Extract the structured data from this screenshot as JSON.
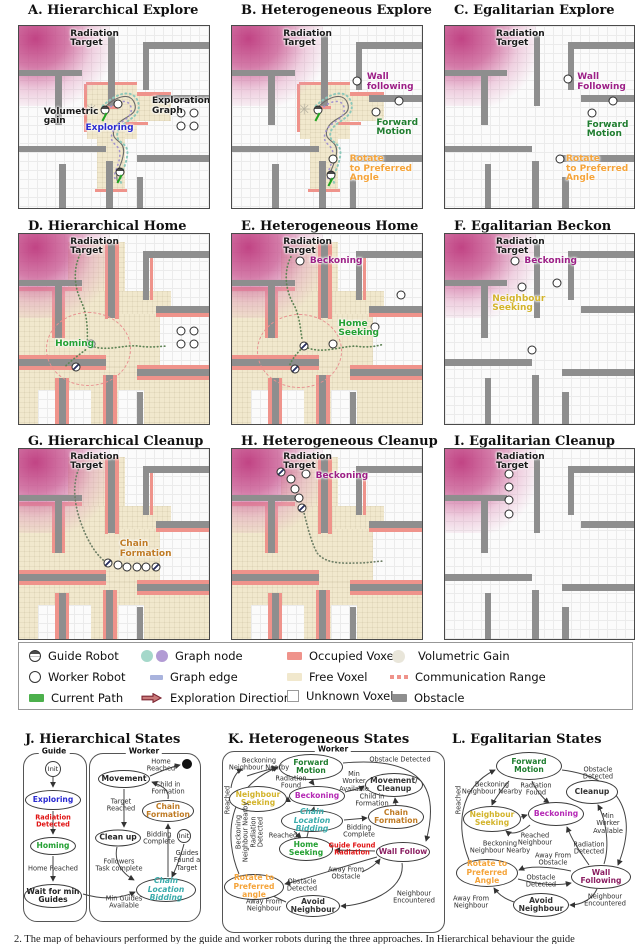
{
  "colors": {
    "radiation_pink": "#c04a82",
    "free_voxel": "#f1e8cd",
    "occupied_voxel": "#ef938b",
    "obstacle_gray": "#8e8e8e",
    "exploring_blue": "#2a2ad0",
    "homing_green": "#23a032",
    "forward_green": "#1f7d2f",
    "beckoning_magenta": "#9c1f86",
    "wall_follow_purple": "#8b1f62",
    "neighbour_yellow": "#d3b42b",
    "rotate_orange": "#f5a43a",
    "chain_brown": "#bf7b24",
    "bidding_teal": "#3aabab",
    "alert_red": "#e01212",
    "graph_node_teal": "#a5d8ca",
    "graph_node_purple": "#b29bd4",
    "graph_edge_lavender": "#a9b3dd",
    "current_path_green": "#4cb04c",
    "exploration_dir_red": "#8e2f3c"
  },
  "panels": [
    {
      "title": "A. Hierarchical Explore",
      "labels": [
        {
          "text": "Radiation\nTarget"
        },
        {
          "text": "Volumetric\ngain"
        },
        {
          "text": "Exploring"
        },
        {
          "text": "Exploration\nGraph"
        }
      ]
    },
    {
      "title": "B. Heterogeneous Explore",
      "labels": [
        {
          "text": "Radiation\nTarget"
        },
        {
          "text": "Wall\nfollowing"
        },
        {
          "text": "Forward\nMotion"
        },
        {
          "text": "Rotate\nto Preferred\nAngle"
        }
      ]
    },
    {
      "title": "C. Egalitarian Explore",
      "labels": [
        {
          "text": "Radiation\nTarget"
        },
        {
          "text": "Wall\nFollowing"
        },
        {
          "text": "Forward\nMotion"
        },
        {
          "text": "Rotate\nto Preferred\nAngle"
        }
      ]
    },
    {
      "title": "D. Hierarchical Home",
      "labels": [
        {
          "text": "Radiation\nTarget"
        },
        {
          "text": "Homing"
        }
      ]
    },
    {
      "title": "E. Heterogeneous Home",
      "labels": [
        {
          "text": "Radiation\nTarget"
        },
        {
          "text": "Beckoning"
        },
        {
          "text": "Home\nSeeking"
        }
      ]
    },
    {
      "title": "F. Egalitarian Beckon",
      "labels": [
        {
          "text": "Radiation\nTarget"
        },
        {
          "text": "Beckoning"
        },
        {
          "text": "Neighbour\nSeeking"
        }
      ]
    },
    {
      "title": "G. Hierarchical Cleanup",
      "labels": [
        {
          "text": "Radiation\nTarget"
        },
        {
          "text": "Chain\nFormation"
        }
      ]
    },
    {
      "title": "H. Heterogeneous Cleanup",
      "labels": [
        {
          "text": "Radiation\nTarget"
        },
        {
          "text": "Beckoning"
        }
      ]
    },
    {
      "title": "I. Egalitarian Cleanup",
      "labels": [
        {
          "text": "Radiation\nTarget"
        }
      ]
    }
  ],
  "legend": {
    "items": [
      {
        "icon": "guide-robot",
        "label": "Guide Robot"
      },
      {
        "icon": "worker-robot",
        "label": "Worker Robot"
      },
      {
        "icon": "current-path",
        "label": "Current Path"
      },
      {
        "icon": "graph-node",
        "label": "Graph node"
      },
      {
        "icon": "graph-edge",
        "label": "Graph edge"
      },
      {
        "icon": "exploration-direction",
        "label": "Exploration Direction"
      },
      {
        "icon": "occupied-voxel",
        "label": "Occupied Voxel"
      },
      {
        "icon": "free-voxel",
        "label": "Free Voxel"
      },
      {
        "icon": "unknown-voxel",
        "label": "Unknown Voxel"
      },
      {
        "icon": "volumetric-gain",
        "label": "Volumetric Gain"
      },
      {
        "icon": "communication-range",
        "label": "Communication Range"
      },
      {
        "icon": "obstacle",
        "label": "Obstacle"
      }
    ]
  },
  "statesJ": {
    "title": "J. Hierarchical States",
    "guide": {
      "label": "Guide",
      "init": "Init",
      "states": [
        "Exploring",
        "Homing",
        "Wait for min\nGuides"
      ],
      "transitions": [
        "Radiation Detected",
        "Home Reached"
      ]
    },
    "worker": {
      "label": "Worker",
      "init": "Init",
      "states": [
        "Movement",
        "Clean up",
        "Chain\nFormation",
        "Chain Location\nBidding"
      ],
      "transitions": [
        "Home\nReached",
        "Child in\nFormation",
        "Target\nReached",
        "Bidding\nComplete",
        "Guides\nFound a\nTarget",
        "Followers\nTask complete",
        "Min Guides\nAvailable"
      ]
    }
  },
  "statesK": {
    "title": "K. Heterogeneous States",
    "container_label": "Worker",
    "states": [
      "Forward\nMotion",
      "Neighbour\nSeeking",
      "Beckoning",
      "Movement/\nCleanup",
      "Chain\nFormation",
      "Chain Location\nBidding",
      "Home\nSeeking",
      "Wall Follow",
      "Rotate to\nPreferred angle",
      "Avoid\nNeighbour"
    ],
    "transitions": [
      "Beckoning\nNeighbour Nearby",
      "Obstacle Detected",
      "Radiation\nFound",
      "Min\nWorker\nAvailable",
      "Child in\nFormation",
      "Bidding\nComplete",
      "Reached",
      "Beckoning\nNeighbour Nearby",
      "Radiation\nDetected",
      "Reached",
      "Guide Found\nRadiation",
      "Away From\nObstacle",
      "Obstacle\nDetected",
      "Neighbour\nEncountered",
      "Away From\nNeighbour"
    ]
  },
  "statesL": {
    "title": "L. Egalitarian States",
    "states": [
      "Forward\nMotion",
      "Cleanup",
      "Neighbour\nSeeking",
      "Beckoning",
      "Rotate to\nPreferred Angle",
      "Wall Following",
      "Avoid\nNeighbour"
    ],
    "transitions": [
      "Obstacle Detected",
      "Beckoning\nNeighbour Nearby",
      "Radiation\nFound",
      "Reached",
      "Reached\nNeighbour",
      "Min\nWorker\nAvailable",
      "Beckoning\nNeighbour Nearby",
      "Radiation\nDetected",
      "Away From\nObstacle",
      "Obstacle\nDetected",
      "Away From\nNeighbour",
      "Neighbour\nEncountered"
    ]
  },
  "caption_fragment": "2. The map of behaviours performed by the guide and worker robots during the three approaches. In Hierarchical behaviour the guide"
}
